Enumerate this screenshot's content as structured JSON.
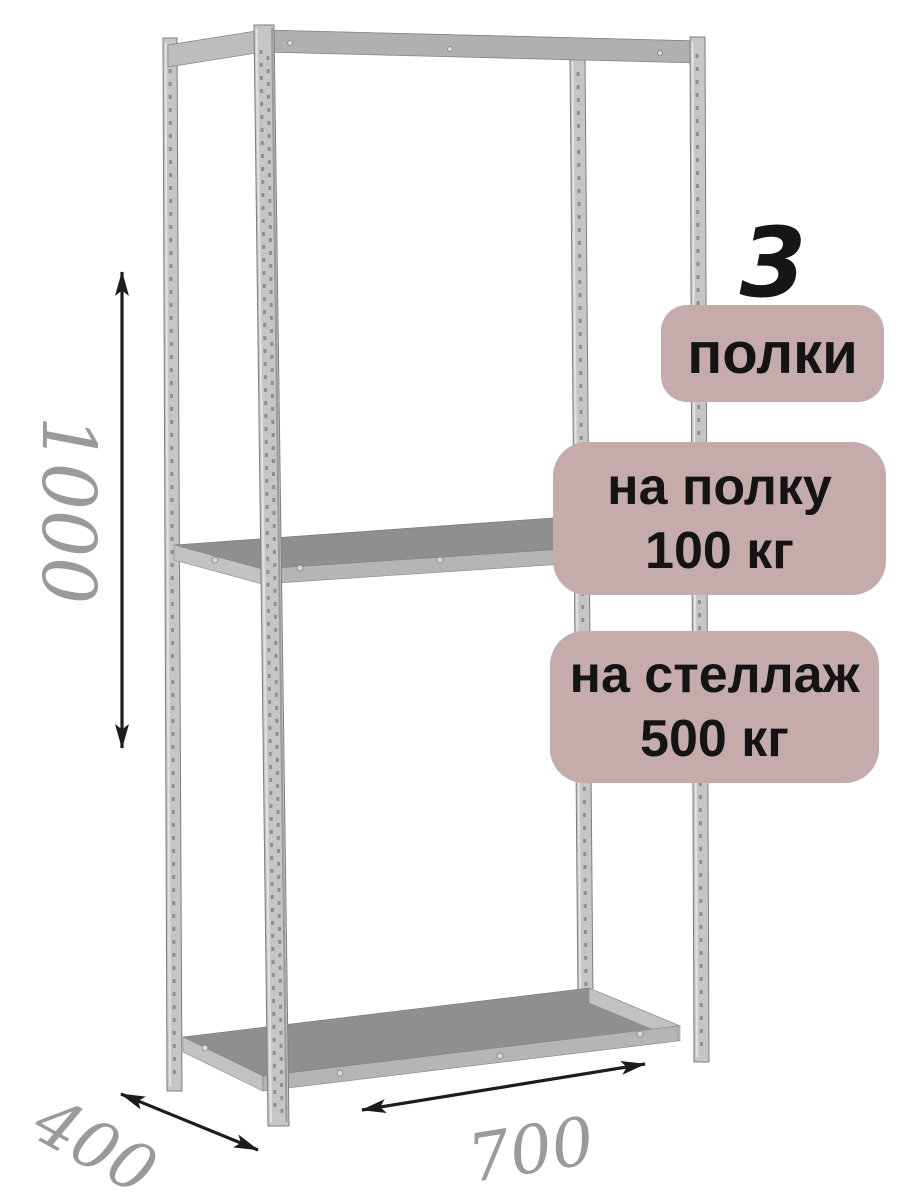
{
  "dimensions": {
    "height": "1000",
    "depth": "400",
    "width": "700"
  },
  "callouts": {
    "shelf_count_number": "3",
    "shelf_count_label": "полки",
    "per_shelf_load_line1": "на полку",
    "per_shelf_load_line2": "100 кг",
    "per_rack_load_line1": "на стеллаж",
    "per_rack_load_line2": "500 кг"
  },
  "colors": {
    "background": "#ffffff",
    "badge_background": "#c5abab",
    "badge_text": "#141414",
    "dimension_label": "#9a9a9a",
    "arrow": "#1c1c1c",
    "metal_shelf_surface": "#8f8f8f",
    "metal_shelf_edge": "#b5b5b5",
    "metal_post": "#c6c6c6"
  }
}
